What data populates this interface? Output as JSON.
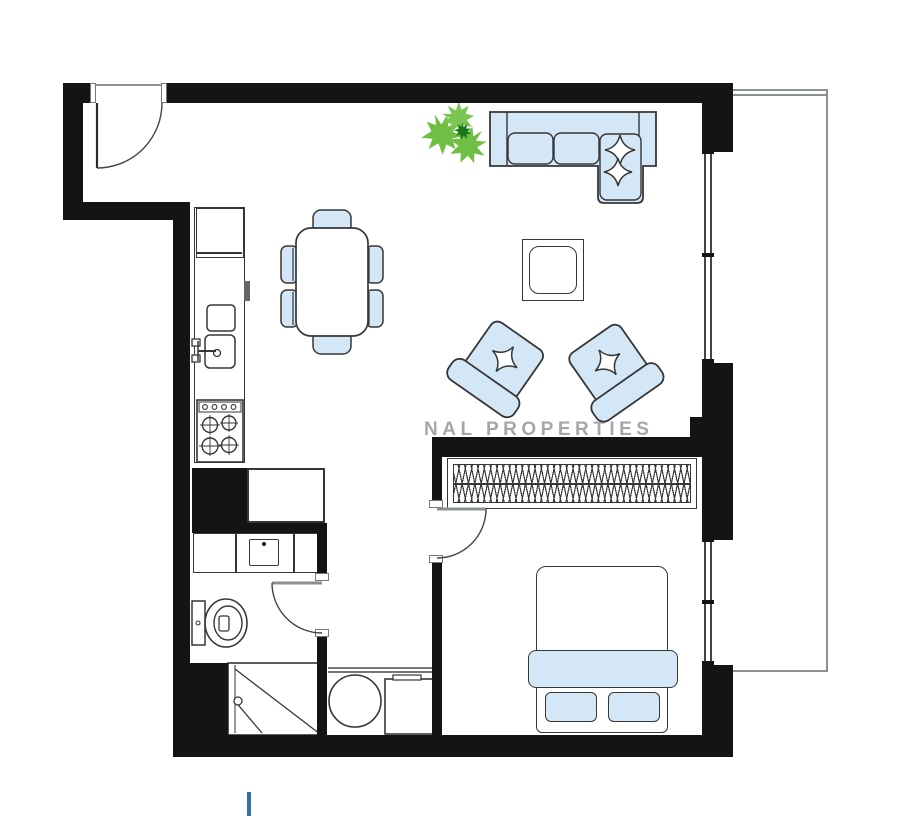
{
  "watermark": {
    "text": "NAL PROPERTIES"
  },
  "colors": {
    "wall": "#141414",
    "stroke": "#363636",
    "furn": "#d4e7f6",
    "thin": "#8a8f93",
    "wm": "#a3a7ab",
    "green": "#6fbf44",
    "green-dark": "#187818",
    "cursor": "#2f6fae"
  },
  "rooms": [
    {
      "name": "entry-hall"
    },
    {
      "name": "living-dining-kitchen"
    },
    {
      "name": "bedroom"
    },
    {
      "name": "bathroom"
    },
    {
      "name": "utility-closet"
    },
    {
      "name": "balcony"
    }
  ],
  "furniture": [
    "floor-plant",
    "l-shaped-sofa",
    "throw-pillows",
    "coffee-table",
    "armchair-left",
    "armchair-right",
    "dining-table",
    "dining-chairs-x6",
    "kitchen-counter",
    "refrigerator",
    "kitchen-sink",
    "stove-4-burner",
    "hall-closet",
    "vanity-basin",
    "toilet",
    "corner-shower",
    "washing-machine",
    "water-heater-cabinet",
    "wardrobe-hanging-rail",
    "double-bed",
    "bed-blanket",
    "bed-pillows-x2",
    "entry-door",
    "bedroom-door",
    "bathroom-door",
    "windows",
    "balcony-railing"
  ]
}
